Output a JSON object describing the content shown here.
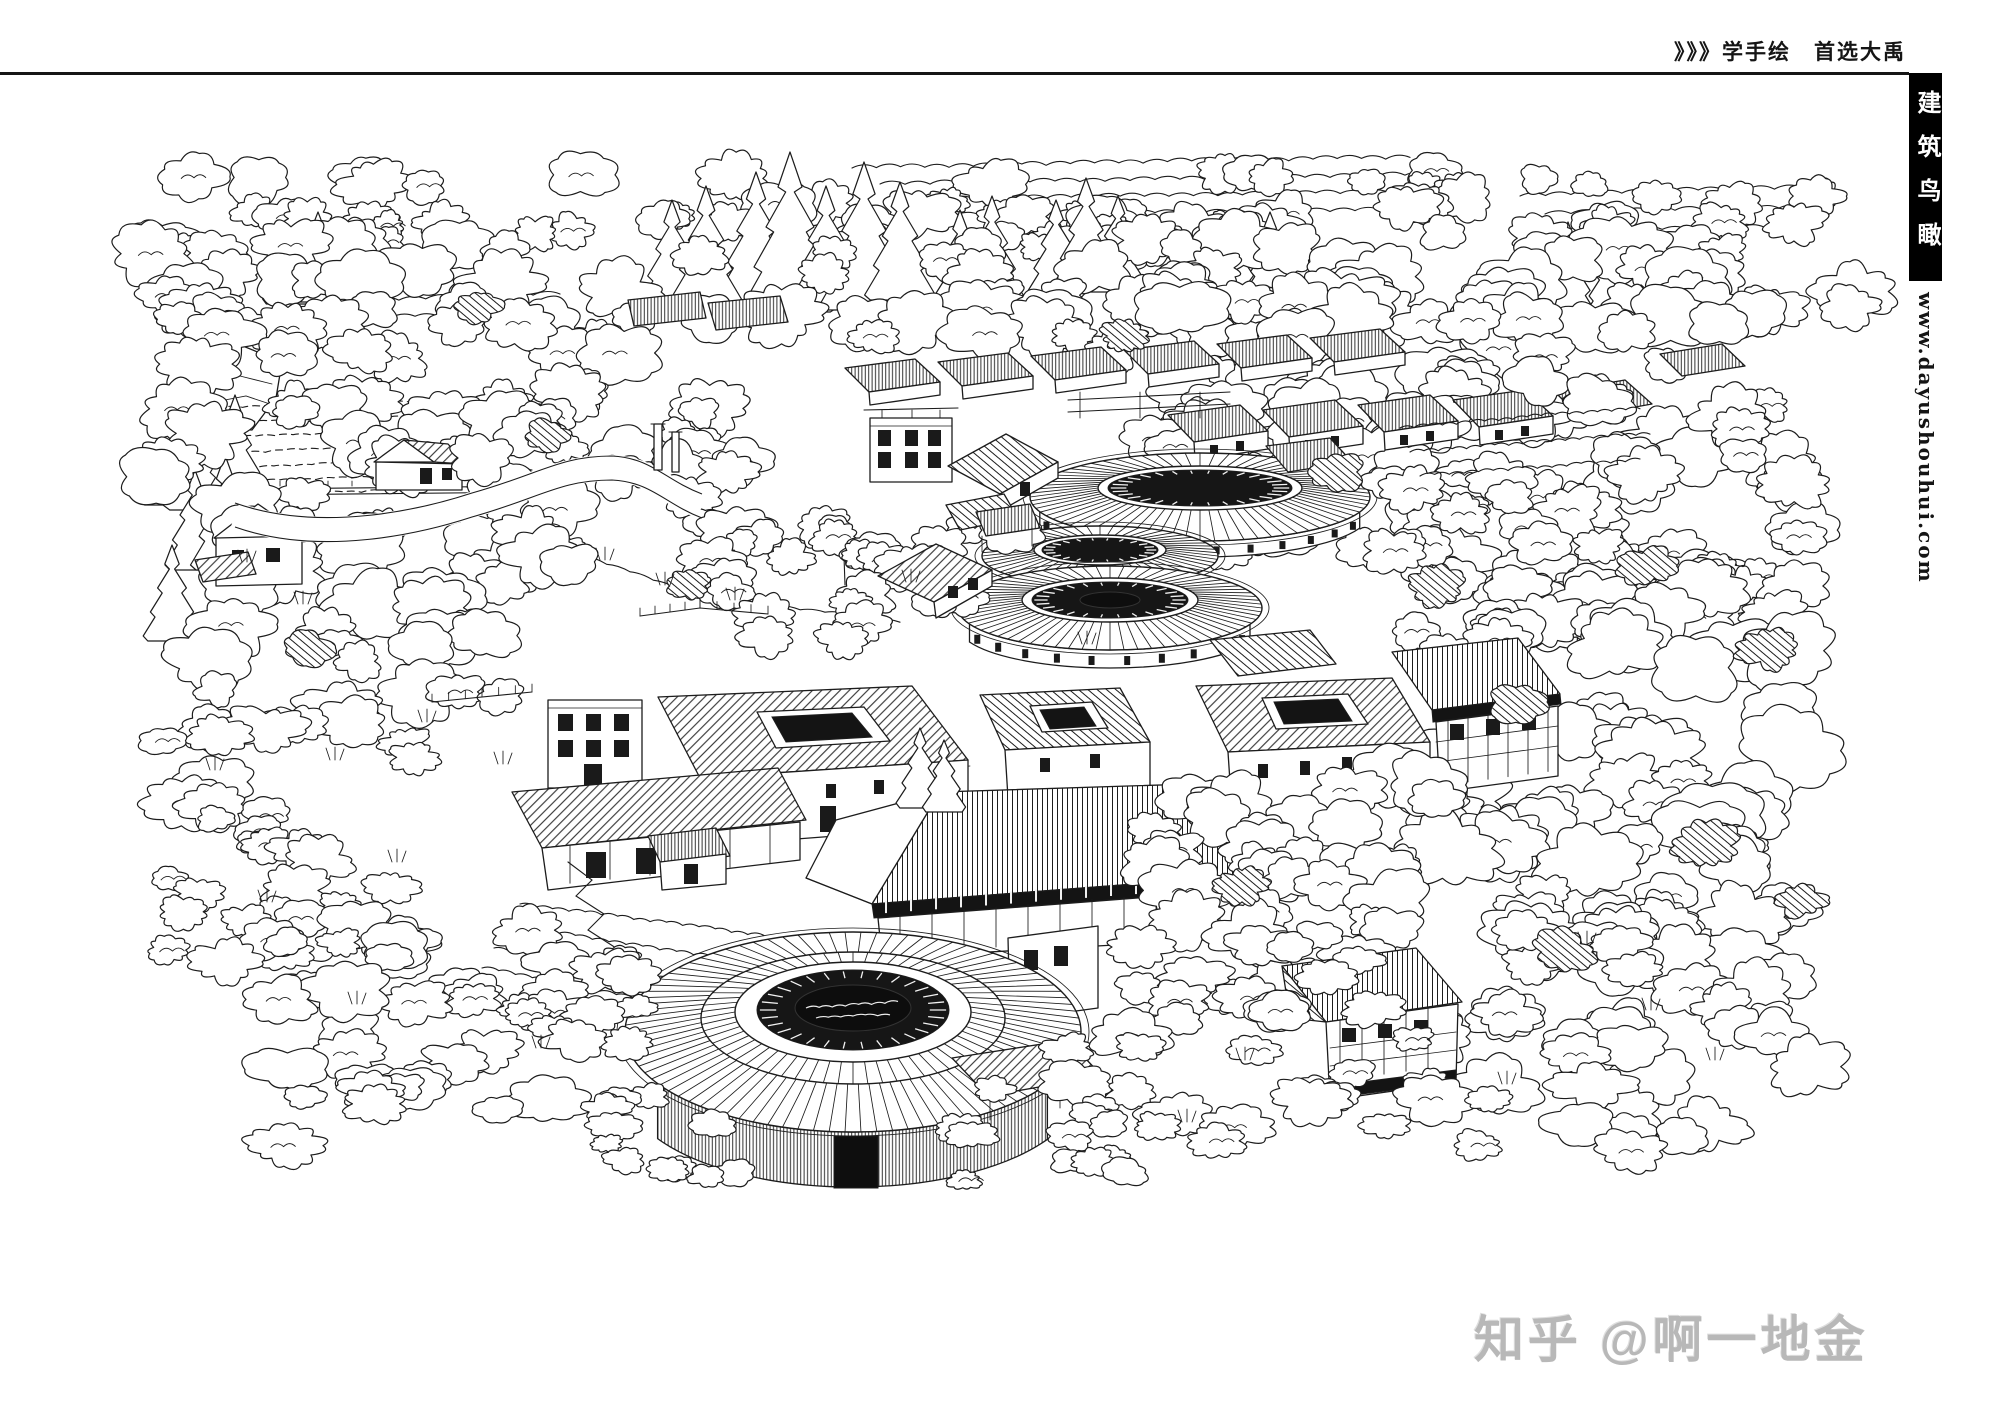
{
  "header": {
    "promo_text": "》》》学手绘　首选大禹"
  },
  "side_column": {
    "tab_title": "建筑鸟瞰",
    "website_url": "www.dayushouhui.com"
  },
  "watermark": {
    "text": "知乎 @啊一地金"
  },
  "colors": {
    "ink": "#1c1c1c",
    "tab_background": "#000000",
    "tab_text": "#ffffff",
    "watermark_gray": "#b8b8b8",
    "page_background": "#ffffff"
  }
}
